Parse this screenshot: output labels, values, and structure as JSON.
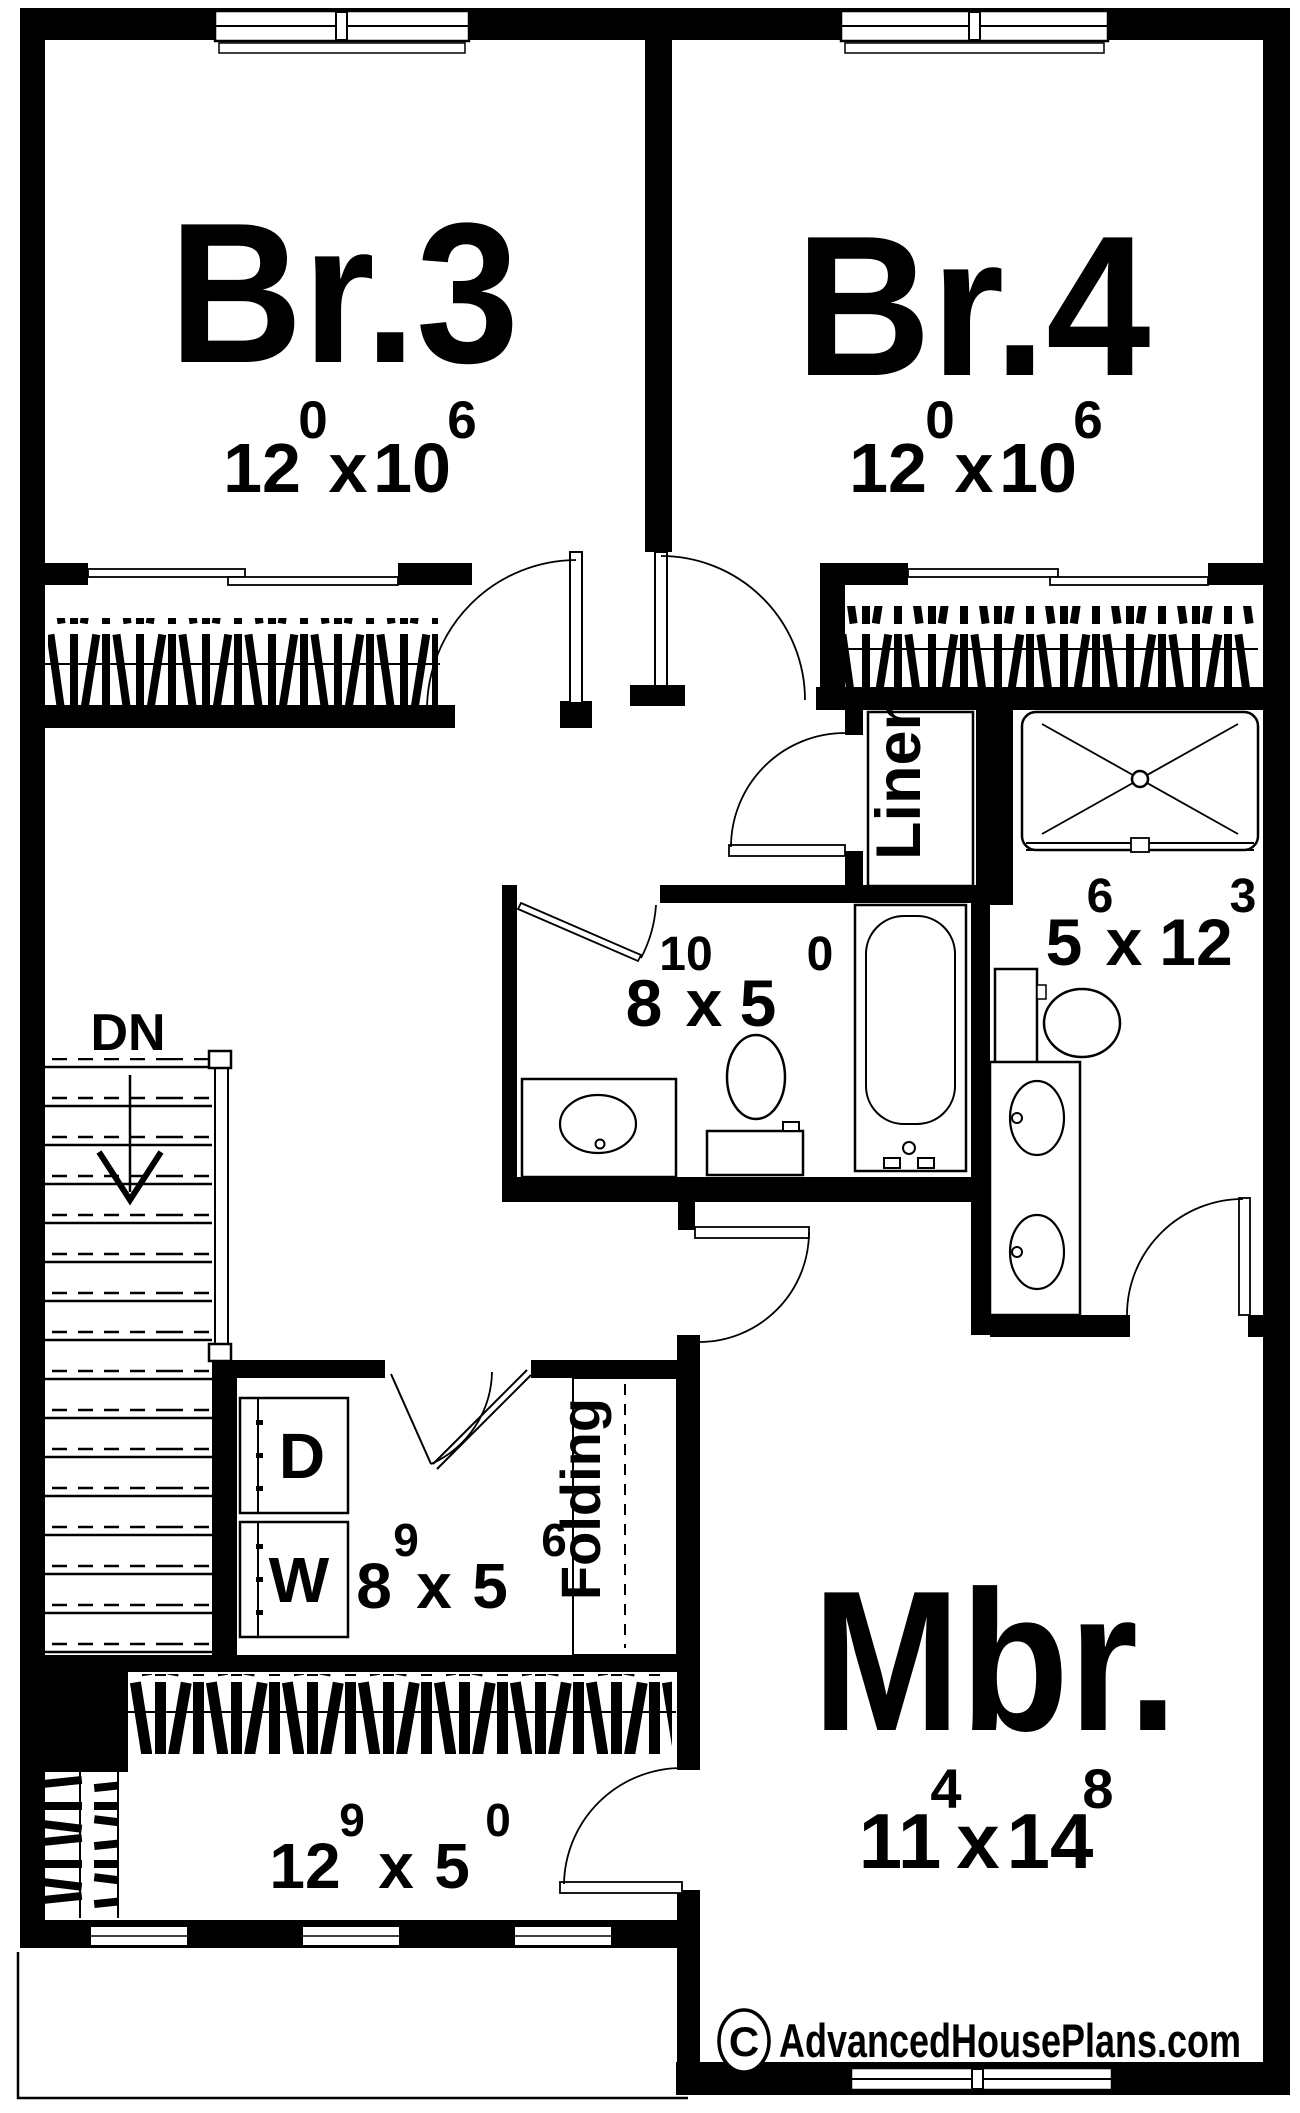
{
  "labels": {
    "dn": "DN",
    "linen": "Linen",
    "folding": "Folding",
    "dryer": "D",
    "washer": "W",
    "times": "x"
  },
  "rooms": {
    "br3": {
      "name": "Br.3",
      "dim_a": "12",
      "sup_a": "0",
      "dim_b": "10",
      "sup_b": "6"
    },
    "br4": {
      "name": "Br.4",
      "dim_a": "12",
      "sup_a": "0",
      "dim_b": "10",
      "sup_b": "6"
    },
    "hall_bath": {
      "dim_a": "8",
      "sup_a": "10",
      "dim_b": "5",
      "sup_b": "0"
    },
    "master_bath": {
      "dim_a": "5",
      "sup_a": "6",
      "dim_b": "12",
      "sup_b": "3"
    },
    "laundry": {
      "dim_a": "8",
      "sup_a": "9",
      "dim_b": "5",
      "sup_b": "6"
    },
    "mbr": {
      "name": "Mbr.",
      "dim_a": "11",
      "sup_a": "4",
      "dim_b": "14",
      "sup_b": "8"
    },
    "closet": {
      "dim_a": "12",
      "sup_a": "9",
      "dim_b": "5",
      "sup_b": "0"
    }
  },
  "watermark": {
    "symbol": "C",
    "text": "AdvancedHousePlans.com"
  },
  "colors": {
    "ink": "#000000",
    "paper": "#ffffff"
  }
}
